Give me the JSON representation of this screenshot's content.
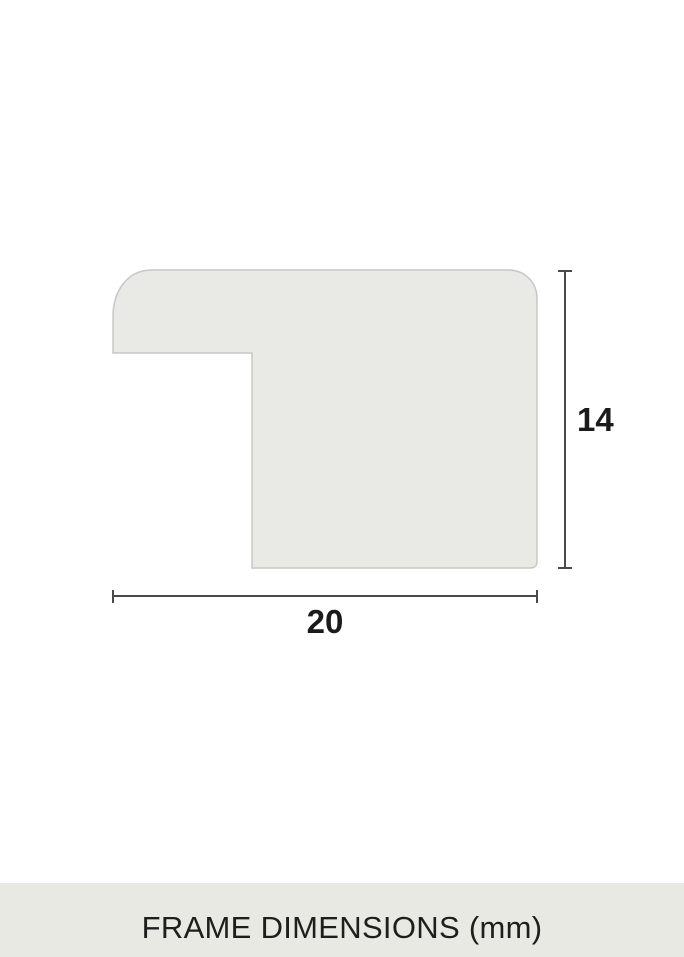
{
  "diagram": {
    "title": "frame-profile-cross-section",
    "width_mm": "20",
    "height_mm": "14",
    "caption": "FRAME DIMENSIONS (mm)",
    "units": "mm",
    "colors": {
      "page_bg": "#ffffff",
      "profile_fill": "#e9e9e6",
      "profile_stroke": "#c7c7c5",
      "dimension_line": "#4a4a4a",
      "label_text": "#1b1b1b",
      "caption_bar_bg": "#e9e9e4",
      "caption_text": "#1e1e1c"
    }
  }
}
